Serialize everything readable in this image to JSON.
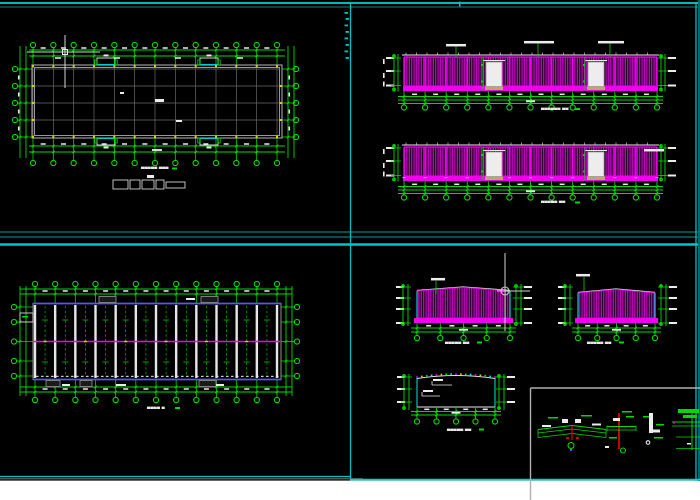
{
  "app": {
    "description": "CAD viewport showing steel workshop drawings: floor plan, side elevations, roof framing plan, gable elevations, section and node details"
  },
  "palette": {
    "bg": "#000000",
    "green": "#00d900",
    "magenta": "#f000f0",
    "magenta_dim": "#dc00dc",
    "cyan": "#00e5e5",
    "frame": "#00c0c0",
    "frame_dim": "#006a6a",
    "white": "#ececec",
    "gray_wall": "#a8a8a8",
    "gray_grid": "#6a6a6a",
    "gray_mid": "#909090",
    "blue": "#5858f0",
    "yellow": "#d8d800",
    "red": "#e00000",
    "khaki": "#c0a860",
    "cursor": "#d4d4d4",
    "paper": "#ffffff",
    "door_fill": "#ededed"
  },
  "titles": {
    "floor_plan": "▄▄▄▄▄ ▄▄▄",
    "elev1": "▄▄▄▄▄▄ ▄▄",
    "elev2": "▄▄▄▄▄ ▄▄",
    "roof_plan": "▄▄▄▄ ▄",
    "gable_a": "▄▄▄▄▄ ▄▄",
    "gable_b": "▄▄▄▄▄ ▄▄",
    "section": "▄▄▄▄▄ ▄▄"
  },
  "title_marks": [
    [
      172,
      167.5
    ],
    [
      575,
      108
    ],
    [
      575,
      201.5
    ],
    [
      175,
      407
    ],
    [
      477,
      341.5
    ],
    [
      619,
      341.5
    ],
    [
      479,
      428.5
    ]
  ],
  "frame": {
    "white_strip": [
      0,
      480.6,
      700,
      19.4
    ],
    "lines": [
      [
        0,
        3,
        700,
        3,
        "#00d0d0",
        1.7
      ],
      [
        0,
        7,
        700,
        7,
        "#008a8a",
        1
      ],
      [
        350.5,
        2,
        350.5,
        480,
        "#00c0c0",
        1.3
      ],
      [
        0,
        232,
        700,
        232,
        "#00a0a0",
        1
      ],
      [
        0,
        237,
        700,
        237,
        "#00a0a0",
        1
      ],
      [
        0,
        244.5,
        700,
        244.5,
        "#00c6c6",
        2.6
      ],
      [
        696,
        2,
        696,
        481,
        "#00c0c0",
        1.3
      ],
      [
        699,
        0,
        699,
        481,
        "#006a6a",
        2
      ],
      [
        0,
        476.5,
        350,
        476.5,
        "#00c0c0",
        1.3
      ],
      [
        0,
        478.8,
        363,
        478.8,
        "#6f6f6f",
        1.2
      ],
      [
        350,
        479.6,
        700,
        479.6,
        "#00d0d0",
        1.8
      ]
    ],
    "ticks": [
      [
        344.5,
        12
      ],
      [
        345.5,
        18
      ],
      [
        344.5,
        24.5
      ],
      [
        345.5,
        31
      ],
      [
        344.5,
        37.5
      ],
      [
        345.5,
        44
      ],
      [
        344.5,
        50.5
      ],
      [
        345.5,
        57
      ]
    ],
    "top_tick": [
      459,
      1.5,
      1.5,
      5
    ]
  },
  "floor_plan": {
    "grid": {
      "x0": 33,
      "x1": 277,
      "n": 13
    },
    "rows": [
      69,
      86,
      103,
      120,
      137
    ],
    "wall": {
      "x": 32,
      "y": 65,
      "w": 250,
      "h": 73
    },
    "bubbles": {
      "top_y": 45,
      "bot_y": 163,
      "left_x": 15,
      "right_x": 296,
      "r": 2.6
    },
    "dims": {
      "top": [
        50,
        56
      ],
      "bot": [
        146,
        152
      ],
      "left": [
        20,
        26
      ],
      "right": [
        288,
        294
      ]
    },
    "openings": {
      "top_x": [
        97,
        200
      ],
      "bot_x": [
        97,
        200
      ],
      "w": 18,
      "h": 7
    },
    "center_marks": [
      [
        155,
        99,
        9,
        3
      ],
      [
        176,
        120,
        6,
        2
      ],
      [
        120,
        92,
        4,
        2
      ]
    ],
    "row2_smear_x": [
      58,
      117,
      178,
      240
    ],
    "legend": {
      "boxes": [
        [
          113,
          180,
          15,
          9
        ],
        [
          130,
          180,
          10,
          9
        ],
        [
          142,
          180,
          12,
          9
        ],
        [
          156,
          180,
          8,
          9
        ],
        [
          166,
          182,
          19,
          6
        ]
      ],
      "tick": [
        147,
        175,
        7,
        3
      ]
    }
  },
  "elevations": {
    "grid": {
      "x0": 404,
      "x1": 657,
      "n": 13
    },
    "stack_left": {
      "lines": [
        394,
        398
      ],
      "mark_x": 386
    },
    "stack_right": {
      "lines": [
        661,
        665
      ],
      "mark_x": 668
    },
    "doors_x": [
      486,
      588
    ],
    "door_w": 16,
    "items": [
      {
        "roof": 55,
        "ptop": 57,
        "pbot": 86.5,
        "base_h": 4.5,
        "door_top": 62,
        "dims": [
          96.5,
          100,
          103.5
        ],
        "bub_y": 107.5,
        "labels": [
          [
            446,
            44,
            20
          ],
          [
            524,
            41,
            30
          ],
          [
            598,
            41,
            26
          ]
        ],
        "leaders": [
          [
            456,
            46.5,
            57
          ],
          [
            538,
            43.5,
            57
          ],
          [
            610,
            43.5,
            57
          ]
        ],
        "cyan_base": false
      },
      {
        "roof": 145,
        "ptop": 147,
        "pbot": 176.5,
        "base_h": 4.5,
        "door_top": 152,
        "dims": [
          186.5,
          190,
          193.5
        ],
        "bub_y": 197.5,
        "labels": [
          [
            644,
            149,
            20
          ]
        ],
        "leaders": [],
        "cyan_base": true
      }
    ]
  },
  "roof_plan": {
    "grid": {
      "x0": 35,
      "x1": 277,
      "n": 13
    },
    "rows": [
      307,
      322,
      341.5,
      361,
      376
    ],
    "rect": {
      "x": 33,
      "y": 303,
      "w": 248,
      "h": 77
    },
    "ridge_y": 341.5,
    "bubbles": {
      "top_y": 284,
      "bot_y": 400,
      "left_x": 14,
      "right_x": 297,
      "r": 2.6
    },
    "dims": {
      "top": [
        289,
        294
      ],
      "bot": [
        387,
        392
      ],
      "left": [
        20,
        26
      ],
      "right": [
        286,
        292
      ]
    },
    "top_vents": [
      [
        99,
        296.5,
        17,
        6
      ],
      [
        201,
        296.5,
        17,
        6
      ]
    ],
    "bot_vents": [
      [
        46,
        380.5,
        14,
        6
      ],
      [
        80,
        380.5,
        12,
        6
      ],
      [
        199,
        380.5,
        17,
        6
      ]
    ],
    "white_marks": [
      [
        186,
        298,
        9,
        2
      ],
      [
        62,
        384,
        8,
        2
      ],
      [
        116,
        384,
        10,
        2
      ],
      [
        216,
        384,
        8,
        2
      ]
    ],
    "protrusion": [
      20,
      313,
      13,
      9
    ]
  },
  "gables": [
    {
      "x0": 417,
      "x1": 510,
      "peak_x": 463,
      "ytop": 291,
      "ypeak": 287.5,
      "ybot": 318,
      "base_y": 318,
      "base_h": 5,
      "bx0": 414,
      "bx1": 513,
      "dims": [
        328,
        332
      ],
      "bub_y": 338,
      "n": 5,
      "stack_left": {
        "lines": [
          403,
          408
        ],
        "mark_x": 396
      },
      "stack_right": {
        "lines": [
          516,
          521
        ],
        "mark_x": 524
      },
      "stack_ytop": 284,
      "stack_ybot": 326,
      "label": [
        431,
        278,
        14
      ],
      "leader": [
        436,
        281,
        294
      ]
    },
    {
      "x0": 578,
      "x1": 655,
      "peak_x": 616,
      "ytop": 293,
      "ypeak": 289.5,
      "ybot": 318,
      "base_y": 318,
      "base_h": 5,
      "bx0": 575,
      "bx1": 658,
      "dims": [
        328,
        332
      ],
      "bub_y": 338,
      "n": 5,
      "stack_left": {
        "lines": [
          565,
          570
        ],
        "mark_x": 558
      },
      "stack_right": {
        "lines": [
          661,
          666
        ],
        "mark_x": 669
      },
      "stack_ytop": 284,
      "stack_ybot": 326,
      "label": [
        576,
        274,
        14
      ],
      "leader": [
        584,
        277,
        292
      ]
    }
  ],
  "section": {
    "x0": 417,
    "x1": 495,
    "ytop": 378.5,
    "ypeak": 374.5,
    "ybot": 407,
    "n": 5,
    "dims": [
      411.5,
      415
    ],
    "bub_y": 421.5,
    "stack_left": {
      "lines": [
        404,
        409
      ],
      "mark_x": 397
    },
    "stack_right": {
      "lines": [
        499,
        504
      ],
      "mark_x": 507
    },
    "stack_ytop": 374,
    "stack_ybot": 410,
    "callouts": [
      [
        432,
        381,
        452,
        385
      ],
      [
        422,
        392,
        440,
        396
      ]
    ],
    "dot_colors": [
      "#f000f0",
      "#d8d800",
      "#00d900",
      "#00e5e5"
    ]
  },
  "details": {
    "border": {
      "x": 530.5,
      "y": 388,
      "right": 700,
      "bottom": 500,
      "color": "#b0b0b0"
    },
    "prims": [
      [
        "l",
        538,
        429.5,
        572,
        425.5,
        "G",
        1.1
      ],
      [
        "l",
        572,
        425.5,
        606,
        429.5,
        "G",
        1.1
      ],
      [
        "l",
        538,
        433,
        572,
        429,
        "G",
        0.8
      ],
      [
        "l",
        572,
        429,
        606,
        433,
        "G",
        0.8
      ],
      [
        "l",
        538,
        437.5,
        572,
        433.5,
        "G",
        0.8
      ],
      [
        "l",
        572,
        433.5,
        606,
        437.5,
        "G",
        0.8
      ],
      [
        "l",
        538,
        429.5,
        538,
        437.5,
        "G",
        0.8
      ],
      [
        "l",
        606,
        429.5,
        606,
        437.5,
        "G",
        0.8
      ],
      [
        "f",
        562,
        419,
        6,
        4,
        "W"
      ],
      [
        "f",
        575,
        419,
        6,
        4,
        "W"
      ],
      [
        "f",
        542,
        425,
        9,
        2,
        "W"
      ],
      [
        "f",
        592,
        423.5,
        9,
        2,
        "W"
      ],
      [
        "f",
        548,
        417,
        10,
        1.5,
        "G"
      ],
      [
        "f",
        581,
        415,
        11,
        1.5,
        "G"
      ],
      [
        "l",
        572,
        426,
        572,
        440,
        "R",
        1.2
      ],
      [
        "f",
        566,
        437,
        3,
        2,
        "R"
      ],
      [
        "f",
        576,
        437,
        3,
        2,
        "R"
      ],
      [
        "c",
        571,
        445.5,
        3,
        "G"
      ],
      [
        "f",
        570,
        449,
        2,
        2,
        "B"
      ],
      [
        "l",
        619,
        413,
        619,
        449,
        "R",
        1.8
      ],
      [
        "l",
        607,
        426.5,
        636,
        426.5,
        "G",
        1
      ],
      [
        "l",
        607,
        430,
        636,
        430,
        "G",
        0.8
      ],
      [
        "l",
        607,
        425.5,
        607,
        431,
        "G",
        0.8
      ],
      [
        "l",
        636,
        425.5,
        636,
        431,
        "G",
        0.8
      ],
      [
        "f",
        613,
        418,
        7,
        3,
        "W"
      ],
      [
        "f",
        622,
        411,
        10,
        1.5,
        "G"
      ],
      [
        "f",
        626,
        416,
        8,
        1.5,
        "G"
      ],
      [
        "f",
        609,
        437,
        8,
        1.5,
        "G"
      ],
      [
        "c",
        623,
        450.5,
        2.5,
        "G"
      ],
      [
        "f",
        605,
        446,
        4,
        2,
        "W"
      ],
      [
        "f",
        649,
        413,
        4,
        20,
        "W"
      ],
      [
        "f",
        653,
        429.5,
        7,
        3,
        "W"
      ],
      [
        "f",
        656,
        424,
        8,
        1.5,
        "G"
      ],
      [
        "f",
        654,
        437,
        9,
        1.5,
        "G"
      ],
      [
        "f",
        643,
        416,
        6,
        1.5,
        "G"
      ],
      [
        "c",
        648,
        442.5,
        1.8,
        "W"
      ],
      [
        "l",
        672,
        422,
        700,
        422,
        "G",
        1
      ],
      [
        "l",
        672,
        426,
        700,
        426,
        "G",
        0.8
      ],
      [
        "l",
        676,
        437,
        700,
        437,
        "G",
        0.8
      ],
      [
        "l",
        676,
        448.5,
        700,
        448.5,
        "G",
        0.8
      ],
      [
        "l",
        692,
        413,
        692,
        450,
        "G",
        1
      ],
      [
        "f",
        678,
        409,
        21,
        4,
        "G"
      ],
      [
        "f",
        683,
        415,
        14,
        3,
        "G"
      ],
      [
        "f",
        673,
        421.5,
        2,
        2,
        "M"
      ],
      [
        "f",
        687,
        443,
        4,
        1.5,
        "W"
      ]
    ]
  },
  "cursors": {
    "plan_crosshair": {
      "x": 65,
      "y": 52,
      "h": [
        27,
        100
      ],
      "v": [
        35,
        88
      ],
      "box": 5
    },
    "gable_crosshair": {
      "x": 505,
      "y": 291,
      "h": [
        497,
        530
      ],
      "v": [
        253,
        331
      ],
      "r": 4
    }
  }
}
